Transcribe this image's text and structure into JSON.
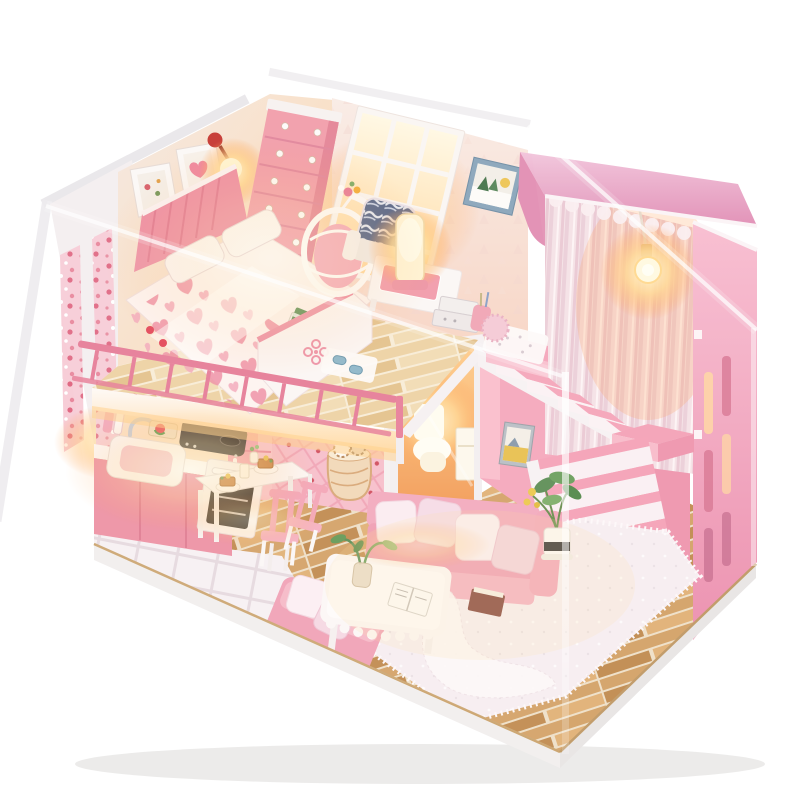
{
  "meta": {
    "kind": "product-photo",
    "subject": "DIY miniature dollhouse kit, pink loft apartment with warm LED lighting, shown inside a clear acrylic dust cover on a white background"
  },
  "palette": {
    "bg": "#ffffff",
    "acrylic": "#e9e7ea",
    "wallCream": "#f6ebe3",
    "wallWarm": "#fbd9b0",
    "wallPink": "#f3a9bd",
    "wallPinkDeep": "#ee8fa8",
    "roofPink": "#e8a2c2",
    "curtain": "#f5e2e6",
    "curtainStripe": "#eccdd6",
    "railPink": "#e67e98",
    "bedPink": "#ee93a8",
    "bedWhite": "#fdf4f0",
    "sofaPink": "#f2a6ba",
    "pillowPink": "#f7e3ea",
    "navy": "#5d6c8e",
    "green": "#5f8f57",
    "greenLight": "#7fae6a",
    "wood": "#d3a066",
    "woodDark": "#bd864e",
    "woodLight": "#ecd0a0",
    "tile": "#f5eef0",
    "white": "#fbf8f7",
    "glowCore": "#fff6cf",
    "glowWarm": "#ffc97e",
    "glowDeep": "#ff9d4d",
    "dark": "#3a3430",
    "silver": "#c9ced6",
    "red": "#c8403a",
    "watermelon": "#e8565e",
    "slipperBlue": "#8fb7c9",
    "basket": "#f2d9b8",
    "basketLine": "#d9a878",
    "frameBlue": "#8fa9bd",
    "toilet": "#fffcf0"
  },
  "scene": {
    "cover": "clear acrylic display case with reflective edges",
    "lights": [
      "red wall sconce",
      "glowing grid window",
      "cylinder table lamp",
      "hanging pendant bulb under pink canopy",
      "bathroom ceiling glow",
      "under-loft warm strip"
    ],
    "rooms": [
      {
        "name": "loft-bedroom",
        "items": [
          "framed art x2",
          "red wall sconce",
          "pink chest of drawers with pearl knobs",
          "white grid window",
          "pink plank bed with heart duvet and lace",
          "two pillows",
          "storybook on bed",
          "white hanging egg chair with flowers",
          "navy patterned armchair",
          "white cabinet with pink drawer and glowing lamp",
          "slipper mat with blue slippers",
          "pink loft railing",
          "storage boxes and pencil cup"
        ]
      },
      {
        "name": "kitchen",
        "items": [
          "pink base cabinets",
          "white sink with faucet",
          "dark cooktop with white stock pot",
          "cutting board with watermelon",
          "oven with dark door",
          "pink refrigerator",
          "blossom backsplash"
        ]
      },
      {
        "name": "dining",
        "items": [
          "white dining table",
          "two pink chairs",
          "waffle plates",
          "drink glass",
          "woven basket with blanket rolls"
        ]
      },
      {
        "name": "bathroom",
        "items": [
          "glass-front cubicle",
          "white toilet",
          "small vanity cabinet",
          "warm ceiling light"
        ]
      },
      {
        "name": "staircase",
        "items": [
          "upper pink flight",
          "mid landing",
          "lower pink flight with white risers",
          "pink side wall with small framed print",
          "dotted mat on top platform"
        ]
      },
      {
        "name": "living-room",
        "items": [
          "pink L sofa with five pillows",
          "lace throw",
          "white coffee table with lace cloth",
          "green plant in glass vase",
          "open magazine",
          "potted plant with black-band pot",
          "white rug",
          "parquet wood floor"
        ]
      }
    ]
  }
}
